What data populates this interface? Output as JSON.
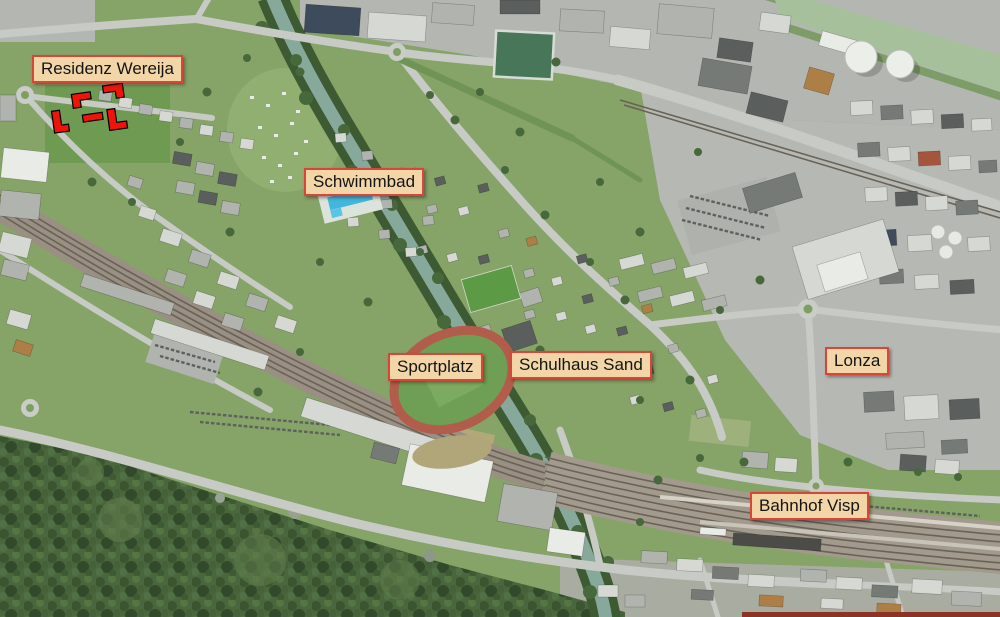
{
  "labels": [
    {
      "id": "residenz-wereija",
      "text": "Residenz Wereija"
    },
    {
      "id": "schwimmbad",
      "text": "Schwimmbad"
    },
    {
      "id": "sportplatz",
      "text": "Sportplatz"
    },
    {
      "id": "schulhaus-sand",
      "text": "Schulhaus Sand"
    },
    {
      "id": "lonza",
      "text": "Lonza"
    },
    {
      "id": "bahnhof-visp",
      "text": "Bahnhof Visp"
    }
  ],
  "colors": {
    "label_bg": "#f3d6a7",
    "label_border": "#d8463a",
    "label_text": "#141414",
    "highlight_red": "#ee1409",
    "water_vispa": "#86a99c",
    "water_rhone": "#a6c09c",
    "pool_blue": "#41b7dd",
    "track_red": "#b25c4b",
    "forest_green": "#4a663c"
  }
}
